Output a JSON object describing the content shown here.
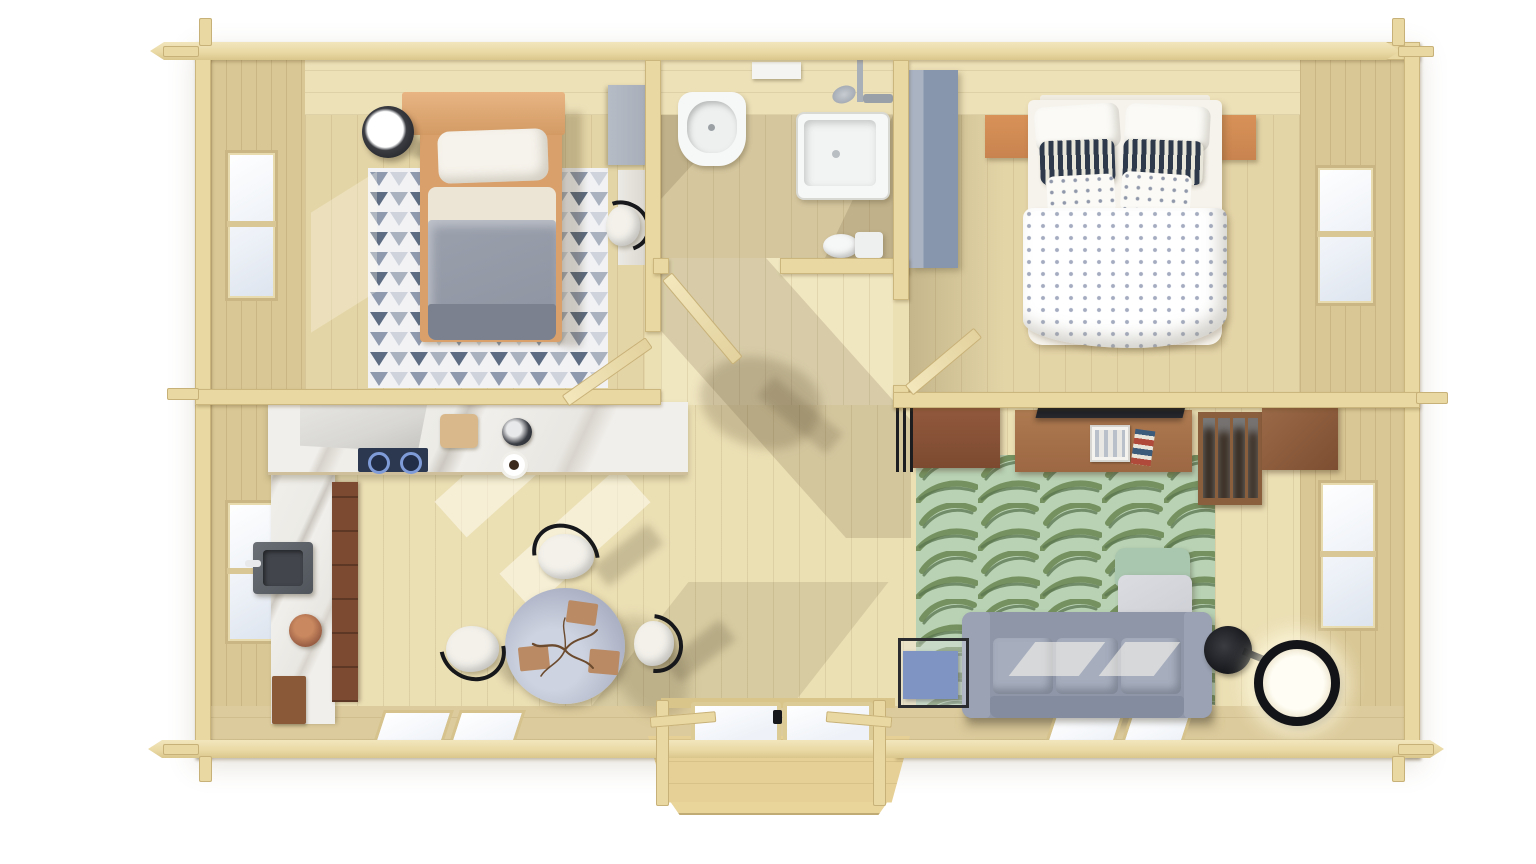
{
  "scene": {
    "type": "3d-top-view-floor-plan",
    "building": "two-bedroom log cabin with porch",
    "rooms": [
      {
        "id": "bedroom-1",
        "position": "top-left",
        "furniture": [
          "single-bed",
          "headboard-shelf",
          "bedside-lamp",
          "triangle-rug",
          "wardrobe",
          "desk",
          "desk-chair"
        ],
        "windows": 1
      },
      {
        "id": "bathroom",
        "position": "top-center",
        "furniture": [
          "wash-basin",
          "wall-shelf",
          "shower-mixer",
          "shower-tray",
          "toilet"
        ],
        "windows": 0
      },
      {
        "id": "bedroom-2",
        "position": "top-right",
        "furniture": [
          "double-bed",
          "nightstand-left",
          "nightstand-right",
          "tall-wardrobe"
        ],
        "windows": 1
      },
      {
        "id": "kitchen-dining",
        "position": "bottom-left",
        "furniture": [
          "marble-counter",
          "extractor-hood",
          "cooktop",
          "cutting-board",
          "coffee-pot",
          "coffee-cup",
          "wall-sink",
          "plant-pot",
          "floor-mat",
          "base-cabinet",
          "round-dining-table",
          "placemat",
          "placemat",
          "placemat",
          "branch-centerpiece",
          "dining-chair",
          "dining-chair",
          "dining-chair"
        ],
        "windows": 3
      },
      {
        "id": "living-room",
        "position": "bottom-right",
        "furniture": [
          "radiator",
          "dresser",
          "tv-sideboard",
          "tv",
          "picture-frame",
          "books",
          "bar-shelf",
          "wall-cabinet",
          "leaf-rug",
          "sofa",
          "armchair",
          "side-table",
          "floor-lamp"
        ],
        "windows": 3
      },
      {
        "id": "hallway",
        "position": "center",
        "doors": [
          "bathroom-door",
          "bedroom-1-door",
          "bedroom-2-door",
          "entrance-double-door"
        ]
      },
      {
        "id": "porch",
        "position": "bottom-center-exterior",
        "furniture": [
          "deck",
          "railing-left",
          "railing-right",
          "steps"
        ]
      }
    ],
    "palette": {
      "page_bg": "#ffffff",
      "log_wall": "#e9d8a2",
      "log_edge": "#cdb782",
      "ceiling_plank": "#ede1b8",
      "wall_face": "#d9c795",
      "floor_room": "#e4d5a7",
      "floor_bath": "#d5c69e",
      "floor_hall": "#f0e6c0",
      "floor_main": "#ebdfb4",
      "south_band": "#dccb9c",
      "marble_white": "#efede9",
      "hood_gray": "#d8d7d3",
      "stove_navy": "#2c3850",
      "burner_blue": "#7f9bd8",
      "wood_warm": "#c8834f",
      "wood_mid": "#9c6743",
      "wood_dark": "#7c4a30",
      "rug1_bg": "#f2f2f5",
      "rug1_tri_light": "#cfd4dc",
      "rug1_tri_mid": "#8f9aae",
      "rug1_tri_dark": "#5d6c82",
      "rug2_bg": "#b9d2b4",
      "rug2_leaf": "#6f8a57",
      "rug2_leaf_dark": "#4f6a42",
      "sofa_gray": "#8e96a8",
      "sofa_cushion": "#a6aebe",
      "armchair_gray": "#c9cbd2",
      "armchair_mint": "#a9c6ae",
      "bed1_duvet": "#9aa0ac",
      "bed1_dark": "#7b818e",
      "bed1_fold": "#ece4d4",
      "linen_white": "#f6f3ec",
      "pillow_navy": "#2e3a4c",
      "fixture_white": "#f6f7f7",
      "wardrobe_gray": "#a7adb8",
      "wardrobe_blue": "#8795ad",
      "table_top": "#aeb4c6",
      "placemat": "#b98a64",
      "side_table_blue": "#8094c4",
      "lamp_black": "#15171b",
      "lamp_glow": "#fffdf4",
      "porch_deck": "#e6d095",
      "glass": "#eef2f8",
      "sun": "rgba(255,252,240,0.55)",
      "shade": "rgba(86,70,40,0.16)"
    }
  }
}
